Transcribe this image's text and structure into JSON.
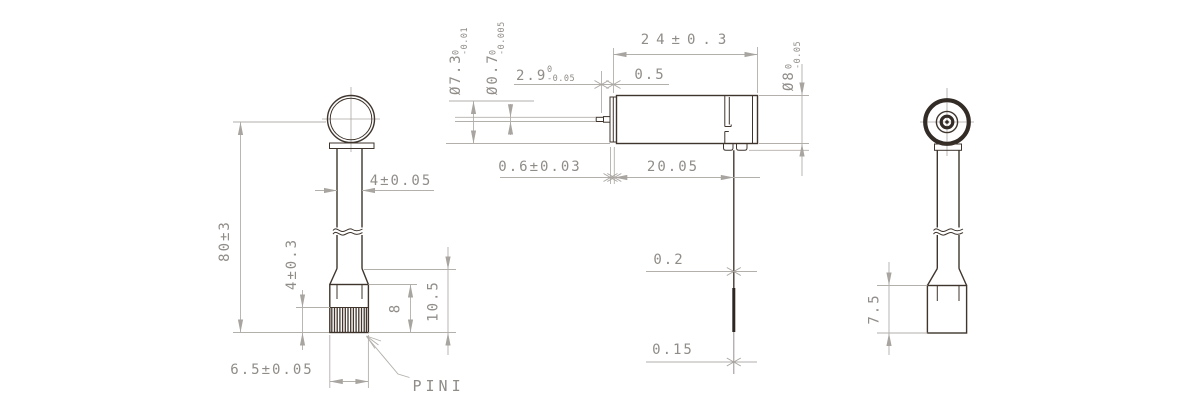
{
  "drawing_type": "engineering-dimension-drawing",
  "colors": {
    "outline": "#3f352d",
    "outline_dark": "#332b25",
    "dimension_line": "#b3afab",
    "text": "#908c88",
    "hatch": "#43362c",
    "background": "#ffffff"
  },
  "left_view": {
    "overall_height": "80±3",
    "stem_width": "4±0.05",
    "pin_section_height": "4±0.3",
    "block_height": "8",
    "lower_height": "10.5",
    "block_width": "6.5±0.05",
    "pin_label": "PINI"
  },
  "center_view": {
    "can_dia": {
      "main": "Ø7.3",
      "tol_top": "0",
      "tol_bot": "-0.01"
    },
    "shaft_dia": {
      "main": "Ø0.7",
      "tol_top": "0",
      "tol_bot": "-0.005"
    },
    "shaft_len": {
      "main": "2.9",
      "tol_top": "0",
      "tol_bot": "-0.05"
    },
    "shaft_step": "0.5",
    "body_length": "24±0.3",
    "housing_dia": {
      "main": "Ø8",
      "tol_top": "0",
      "tol_bot": "-0.05"
    },
    "cap_thickness": "0.6±0.03",
    "face_to_lead": "20.05",
    "lead_dia_upper": "0.2",
    "lead_dia_lower": "0.15"
  },
  "right_view": {
    "block_height": "7.5"
  }
}
